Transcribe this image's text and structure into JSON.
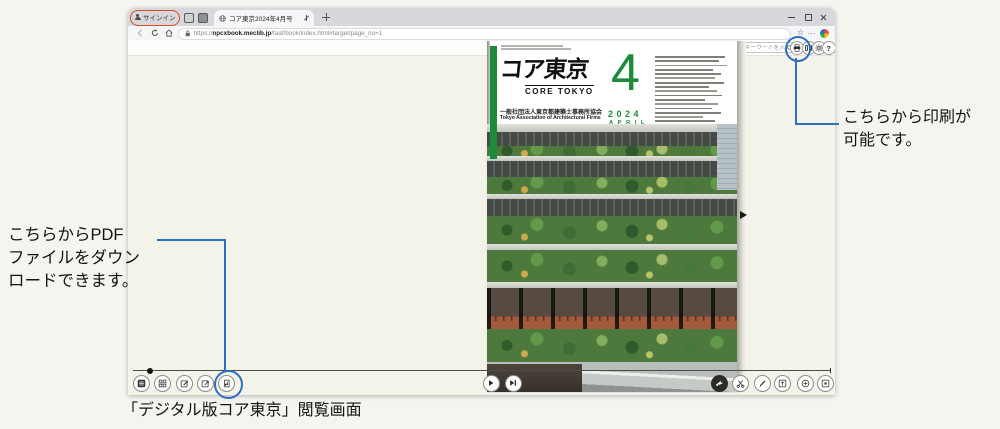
{
  "browser": {
    "signin_label": "サインイン",
    "tab_title": "コア東京2024年4月号",
    "url_scheme": "https://",
    "url_domain": "npcxbook.meclib.jp",
    "url_path": "/taaf/book/index.html#target/page_no=1",
    "star_glyph": "☆",
    "more_glyph": "…"
  },
  "viewer": {
    "page_label": "ページ :",
    "page_current": "1",
    "page_total_label": "/ 28",
    "search_placeholder": "検索キーワードを入力",
    "help_glyph": "?"
  },
  "cover": {
    "brand_green": "#1e8a3c",
    "logo_main": "コア東京",
    "logo_sub": "CORE TOKYO",
    "org_jp": "一般社団法人東京都建築士事務所協会",
    "org_en": "Tokyo Association of Architectural Firms",
    "issue_number": "4",
    "issue_year": "2024",
    "issue_month": "APRIL"
  },
  "annotations": {
    "accent_blue": "#2e6fbe",
    "accent_red": "#d84b28",
    "pdf_note_line1": "こちらからPDF",
    "pdf_note_line2": "ファイルをダウン",
    "pdf_note_line3": "ロードできます。",
    "print_note_line1": "こちらから印刷が",
    "print_note_line2": "可能です。",
    "caption": "「デジタル版コア東京」閲覧画面"
  }
}
